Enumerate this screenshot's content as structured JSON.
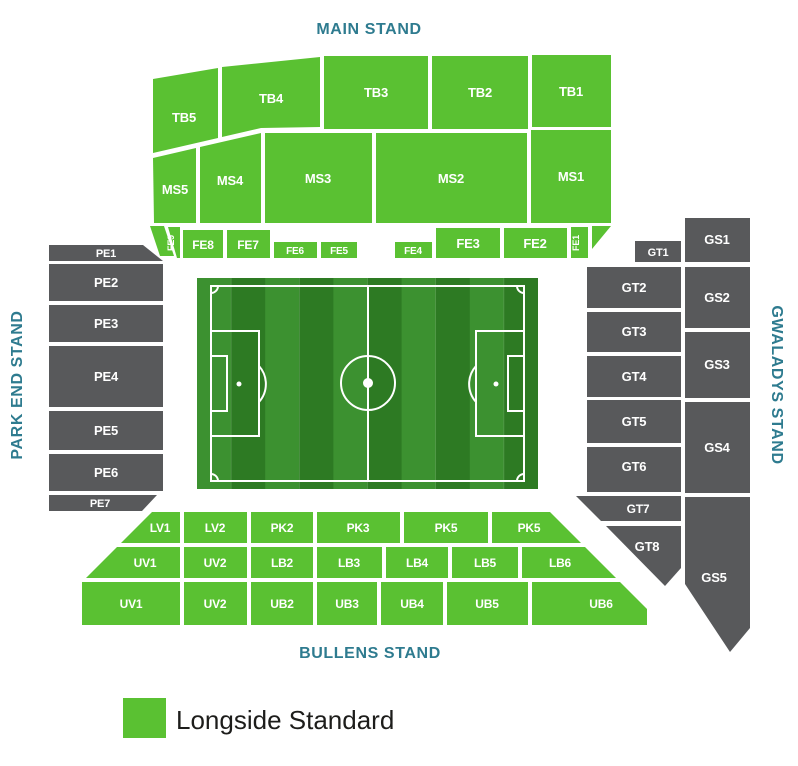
{
  "colors": {
    "block_green": "#5ac132",
    "block_gray": "#58595b",
    "heading_teal": "#2e7b8f",
    "block_label_text": "#ffffff",
    "legend_text": "#1d1d1b",
    "pitch_stripe_light": "#3c9130",
    "pitch_stripe_dark": "#2d7a23",
    "pitch_line": "#ffffff"
  },
  "stands": {
    "main": {
      "label": "MAIN STAND",
      "blocks": {
        "tb5": "TB5",
        "tb4": "TB4",
        "tb3": "TB3",
        "tb2": "TB2",
        "tb1": "TB1",
        "ms5": "MS5",
        "ms4": "MS4",
        "ms3": "MS3",
        "ms2": "MS2",
        "ms1": "MS1",
        "fe9": "FE9",
        "fe8": "FE8",
        "fe7": "FE7",
        "fe6": "FE6",
        "fe5": "FE5",
        "fe4": "FE4",
        "fe3": "FE3",
        "fe2": "FE2",
        "fe1": "FE1"
      }
    },
    "park_end": {
      "label": "PARK END STAND",
      "blocks": {
        "pe1": "PE1",
        "pe2": "PE2",
        "pe3": "PE3",
        "pe4": "PE4",
        "pe5": "PE5",
        "pe6": "PE6",
        "pe7": "PE7"
      }
    },
    "gwaladys": {
      "label": "GWALADYS STAND",
      "blocks": {
        "gt1": "GT1",
        "gt2": "GT2",
        "gt3": "GT3",
        "gt4": "GT4",
        "gt5": "GT5",
        "gt6": "GT6",
        "gt7": "GT7",
        "gt8": "GT8",
        "gs1": "GS1",
        "gs2": "GS2",
        "gs3": "GS3",
        "gs4": "GS4",
        "gs5": "GS5"
      }
    },
    "bullens": {
      "label": "BULLENS STAND",
      "blocks": {
        "lv1": "LV1",
        "lv2": "LV2",
        "pk2": "PK2",
        "pk3": "PK3",
        "pk4": "PK4",
        "pk5": "PK5",
        "uv1_upper": "UV1",
        "uv2_upper": "UV2",
        "lb2": "LB2",
        "lb3": "LB3",
        "lb4": "LB4",
        "lb5": "LB5",
        "lb6": "LB6",
        "uv1_lower": "UV1",
        "uv2_lower": "UV2",
        "ub2": "UB2",
        "ub3": "UB3",
        "ub4": "UB4",
        "ub5": "UB5",
        "ub6": "UB6"
      }
    }
  },
  "legend": {
    "items": [
      {
        "label": "Longside Standard",
        "color": "#5ac132"
      }
    ]
  }
}
